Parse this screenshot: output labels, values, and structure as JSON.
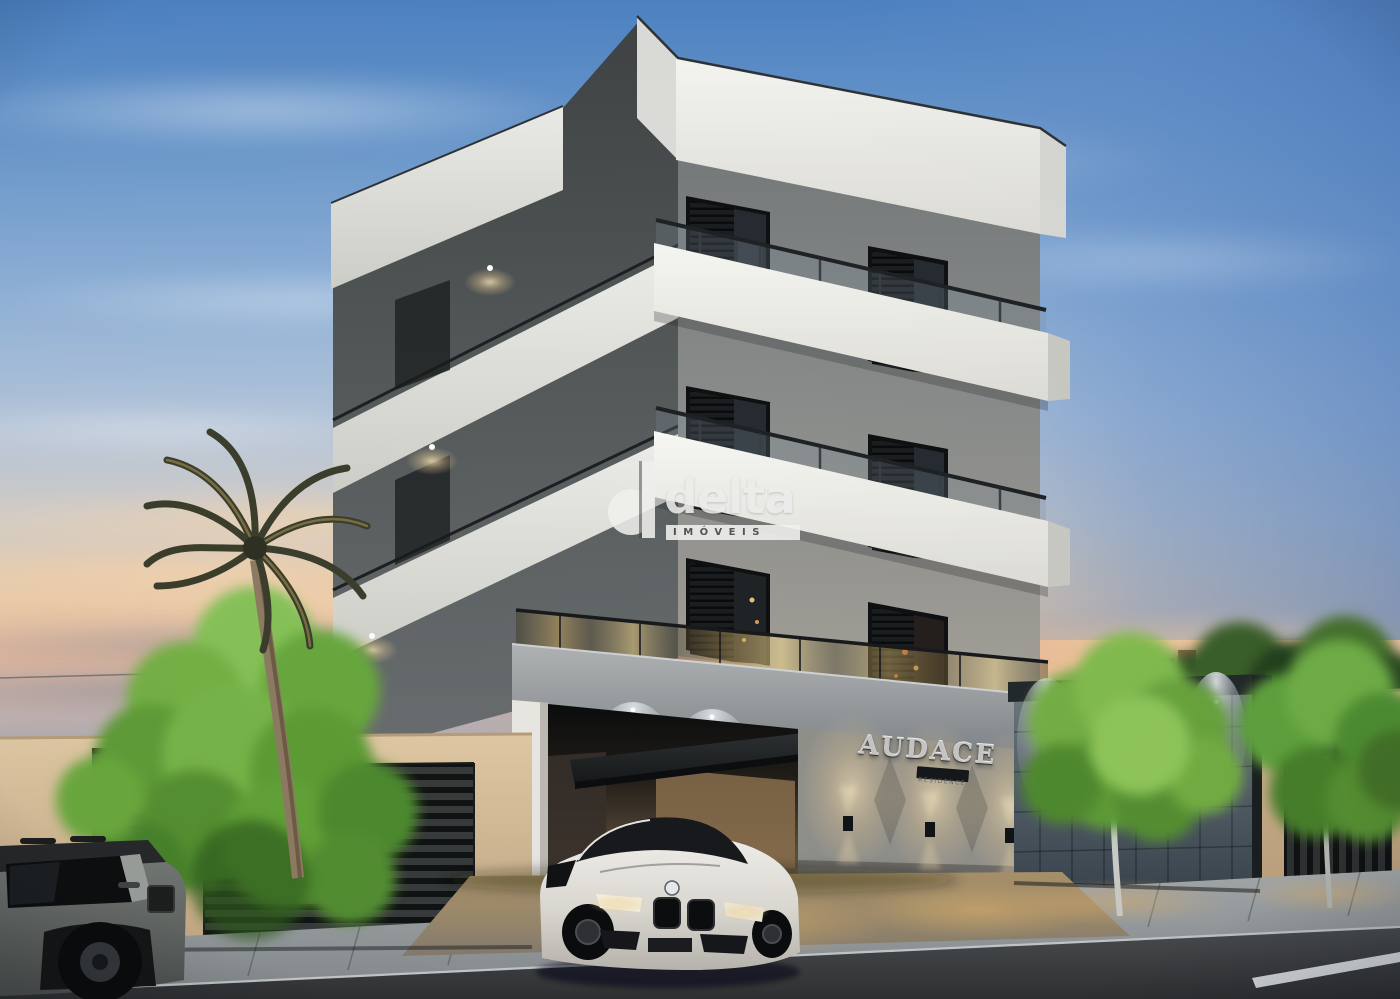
{
  "scene": {
    "type": "3D architectural rendering",
    "subject": "Modern three-storey residential building with rooftop slab, balconies and gated garage, shown at dusk",
    "foreground": "white sports coupe parked under the entrance canopy, gray compact SUV at street left, palm tree and garden trees, neighboring beige walls with slatted gates"
  },
  "watermark": {
    "brand": "delta",
    "subtitle": "IMÓVEIS"
  },
  "sign": {
    "name": "AUDACE",
    "plaque": "RESIDENCE"
  },
  "palette": {
    "sky_top": "#4d82c3",
    "sunset_band": "#ecccaa",
    "facade_front": "#878a89",
    "facade_shadow": "#4b5052",
    "slab_white": "#f2f2ee",
    "wall_beige": "#d8bf9c",
    "tile_wall": "#55606a",
    "street": "#3d4042",
    "warm_light": "#d8b27a"
  }
}
